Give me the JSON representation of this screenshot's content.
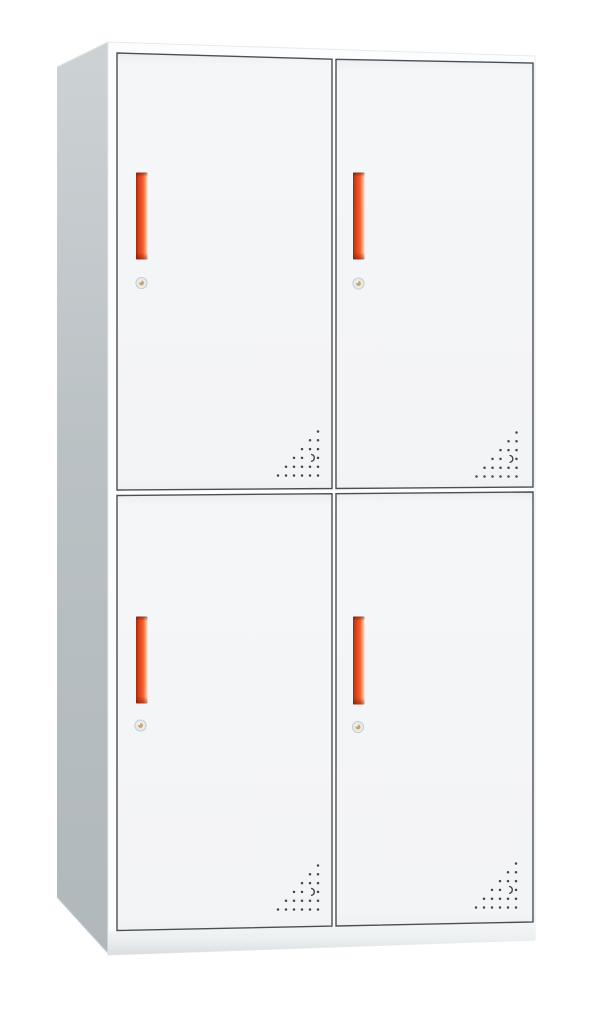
{
  "image": {
    "type": "product-photo",
    "subject": "Four-door steel locker cabinet",
    "view": "front three-quarter from the left",
    "background": "#ffffff"
  },
  "product": {
    "name": "4-door metal locker cabinet",
    "layout": "2 columns x 2 rows",
    "door_count": 4,
    "body_color_name": "white / light gray",
    "handle_color_name": "red-orange",
    "features": [
      "vertical red recessed handles",
      "round cam locks with keyholes",
      "triangular dot vent perforations at door bottom-right corners",
      "plinth base",
      "gray side panel"
    ]
  },
  "doors": [
    {
      "id": "upper-left",
      "handle": true,
      "lock": true,
      "vent": true
    },
    {
      "id": "upper-right",
      "handle": true,
      "lock": true,
      "vent": true
    },
    {
      "id": "lower-left",
      "handle": true,
      "lock": true,
      "vent": true
    },
    {
      "id": "lower-right",
      "handle": true,
      "lock": true,
      "vent": true
    }
  ],
  "colors": {
    "background": "#ffffff",
    "front_face": "#fcfdfe",
    "front_edge": "#e7eaec",
    "door_face": "#f4f5f7",
    "door_face_top_shade": "#e9ecee",
    "door_outline": "#4b4f54",
    "side_top": "#cdd2d5",
    "side_mid": "#bac1c4",
    "side_bottom": "#b1b8bc",
    "side_bottom_edge": "#c2c8cb",
    "handle_dark": "#a22c0c",
    "handle_bright": "#ee5222",
    "handle_fade": "#f7d3bd",
    "keyhole_ring": "#e8eaeb",
    "keyhole_ring_edge": "#c5c9cb",
    "keyhole_center": "#c9a36b",
    "vent_dot": "#43474c",
    "plinth_light": "#f3f5f6",
    "plinth_shadow": "#dadde0"
  },
  "vent": {
    "rows": 6,
    "col_spacing": 8,
    "row_spacing": 8.8,
    "dot_radius": 1.25,
    "crescent_row_from_bottom": 2,
    "crescent_col_from_right": 1
  }
}
